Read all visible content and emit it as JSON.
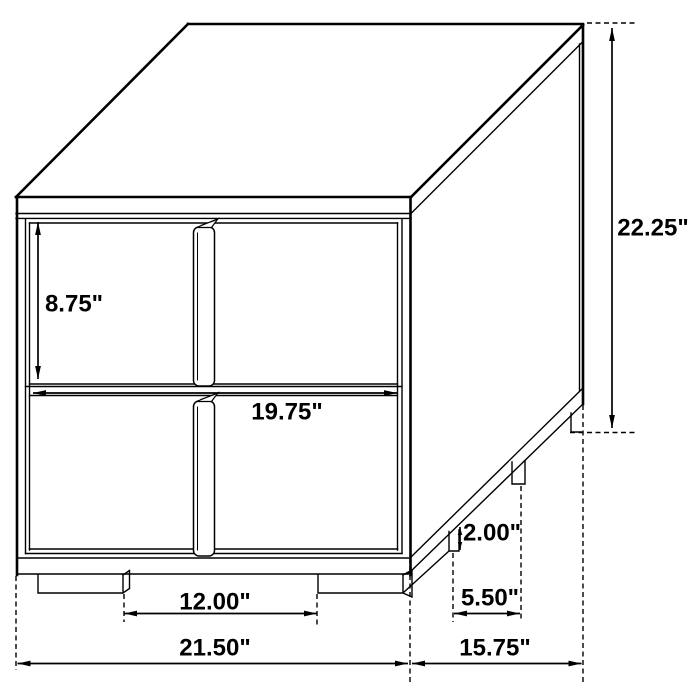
{
  "canvas": {
    "width": 700,
    "height": 700,
    "background": "#ffffff"
  },
  "style": {
    "line_color": "#000000",
    "label_color": "#000000",
    "label_font_size": 24,
    "dash_pattern": [
      5,
      3.5
    ],
    "arrow_length": 13,
    "arrow_half_width": 2.9
  },
  "dimensions": [
    {
      "name": "drawer-height",
      "label": "8.75\"",
      "dir": "v",
      "x": 38,
      "y1": 222,
      "y2": 379,
      "lx": 74,
      "ly": 304
    },
    {
      "name": "overall-height",
      "label": "22.25\"",
      "dir": "v",
      "x": 612,
      "y1": 28,
      "y2": 428,
      "lx": 653,
      "ly": 228
    },
    {
      "name": "foot-height",
      "label": "2.00\"",
      "dir": "v",
      "x": 460,
      "y1": 527,
      "y2": 550,
      "lx": 492,
      "ly": 533,
      "arrow": 8
    },
    {
      "name": "drawer-width",
      "label": "19.75\"",
      "dir": "h",
      "y": 393,
      "x1": 33,
      "x2": 397,
      "lx": 287,
      "ly": 412
    },
    {
      "name": "front-feet-spacing",
      "label": "12.00\"",
      "dir": "h",
      "y": 613.5,
      "x1": 124,
      "x2": 317,
      "lx": 215,
      "ly": 602
    },
    {
      "name": "side-feet-spacing",
      "label": "5.50\"",
      "dir": "h",
      "y": 613.5,
      "x1": 454,
      "x2": 520,
      "lx": 490,
      "ly": 598
    },
    {
      "name": "overall-width",
      "label": "21.50\"",
      "dir": "h",
      "y": 663.5,
      "x1": 17.5,
      "x2": 408,
      "lx": 215,
      "ly": 648
    },
    {
      "name": "overall-depth",
      "label": "15.75\"",
      "dir": "h",
      "y": 663.5,
      "x1": 412,
      "x2": 581.5,
      "lx": 495,
      "ly": 648
    }
  ],
  "extension_lines": [
    {
      "x1": 587,
      "y1": 23,
      "x2": 636,
      "y2": 23
    },
    {
      "x1": 570,
      "y1": 432.5,
      "x2": 636,
      "y2": 432.5
    },
    {
      "x1": 16,
      "y1": 576,
      "x2": 16,
      "y2": 670
    },
    {
      "x1": 124,
      "y1": 594,
      "x2": 124,
      "y2": 622
    },
    {
      "x1": 317,
      "y1": 594,
      "x2": 317,
      "y2": 627
    },
    {
      "x1": 410,
      "y1": 558,
      "x2": 410,
      "y2": 684
    },
    {
      "x1": 583,
      "y1": 405,
      "x2": 583,
      "y2": 684
    },
    {
      "x1": 453,
      "y1": 553,
      "x2": 453,
      "y2": 622
    },
    {
      "x1": 521,
      "y1": 486,
      "x2": 521,
      "y2": 622
    }
  ]
}
